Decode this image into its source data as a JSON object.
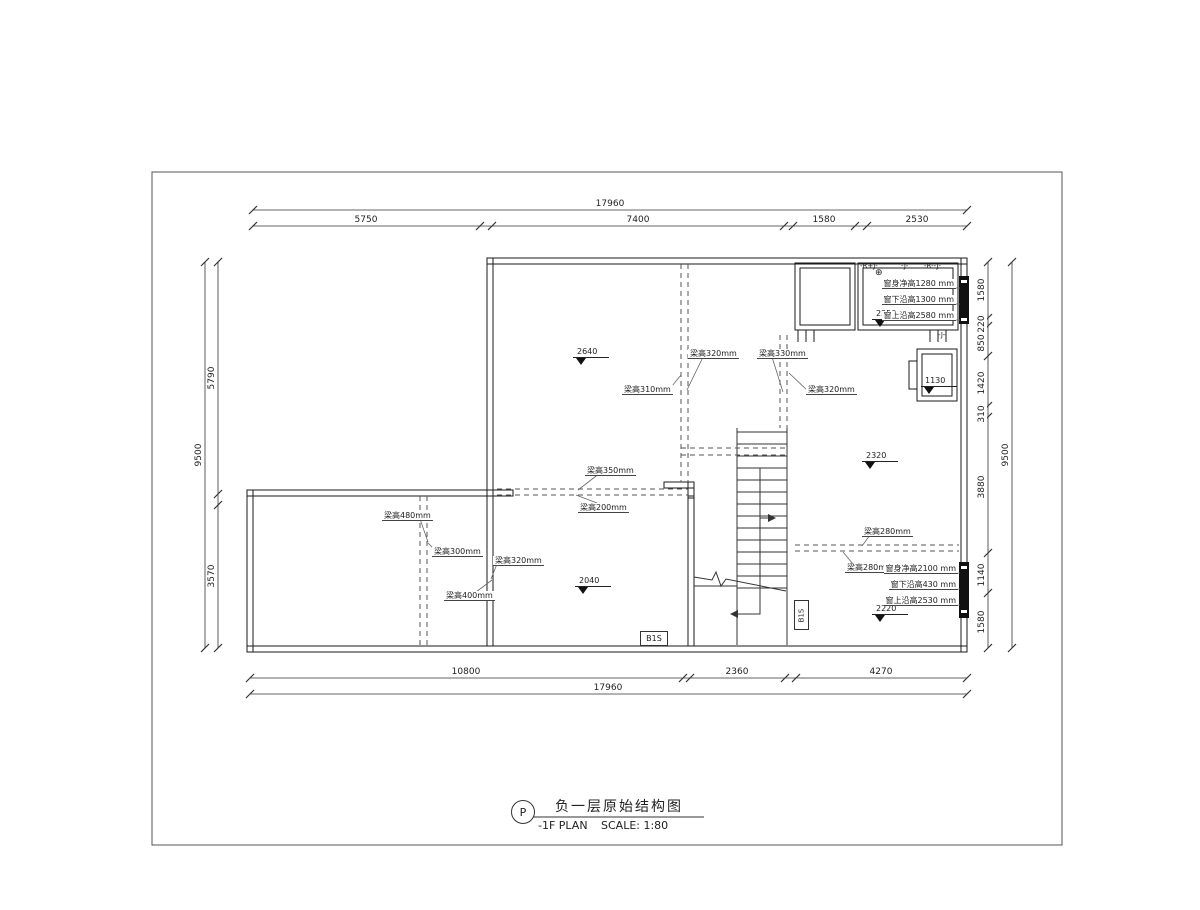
{
  "sheet": {
    "bg": "#ffffff",
    "line_color": "#1a1a1a",
    "dash_color": "#555555"
  },
  "title_block": {
    "bubble": "P",
    "title_cn": "负一层原始结构图",
    "title_en": "-1F PLAN",
    "scale_label": "SCALE: 1:80"
  },
  "dims": {
    "top_total": "17960",
    "top_segments": [
      "5750",
      "7400",
      "1580",
      "2530"
    ],
    "bottom_segments": [
      "10800",
      "2360",
      "4270"
    ],
    "bottom_total": "17960",
    "left_outer": "9500",
    "left_segments": [
      "5790",
      "3570"
    ],
    "right_outer": "9500",
    "right_segments": [
      "1580",
      "220",
      "850",
      "1420",
      "310",
      "3880",
      "1140",
      "1580"
    ]
  },
  "beams": [
    "梁高320mm",
    "梁高330mm",
    "梁高310mm",
    "梁高320mm",
    "梁高350mm",
    "梁高200mm",
    "梁高480mm",
    "梁高300mm",
    "梁高320mm",
    "梁高400mm",
    "梁高280mm",
    "梁高280mm"
  ],
  "elevations": [
    "2640",
    "2040",
    "2320",
    "2220",
    "1130",
    "2250"
  ],
  "window_top": {
    "tag_left": "-R+J-",
    "tag_mid": "-J-",
    "tag_right": "-R--J-",
    "symbol": "⊕",
    "tag_below": "-J-",
    "notes": [
      "窗身净高1280 mm",
      "窗下沿高1300 mm",
      "窗上沿高2580 mm"
    ]
  },
  "window_bottom": {
    "notes": [
      "窗身净高2100 mm",
      "窗下沿高430 mm",
      "窗上沿高2530 mm"
    ]
  },
  "stair_tags": {
    "box": "B1S",
    "shaft": "B1S"
  }
}
